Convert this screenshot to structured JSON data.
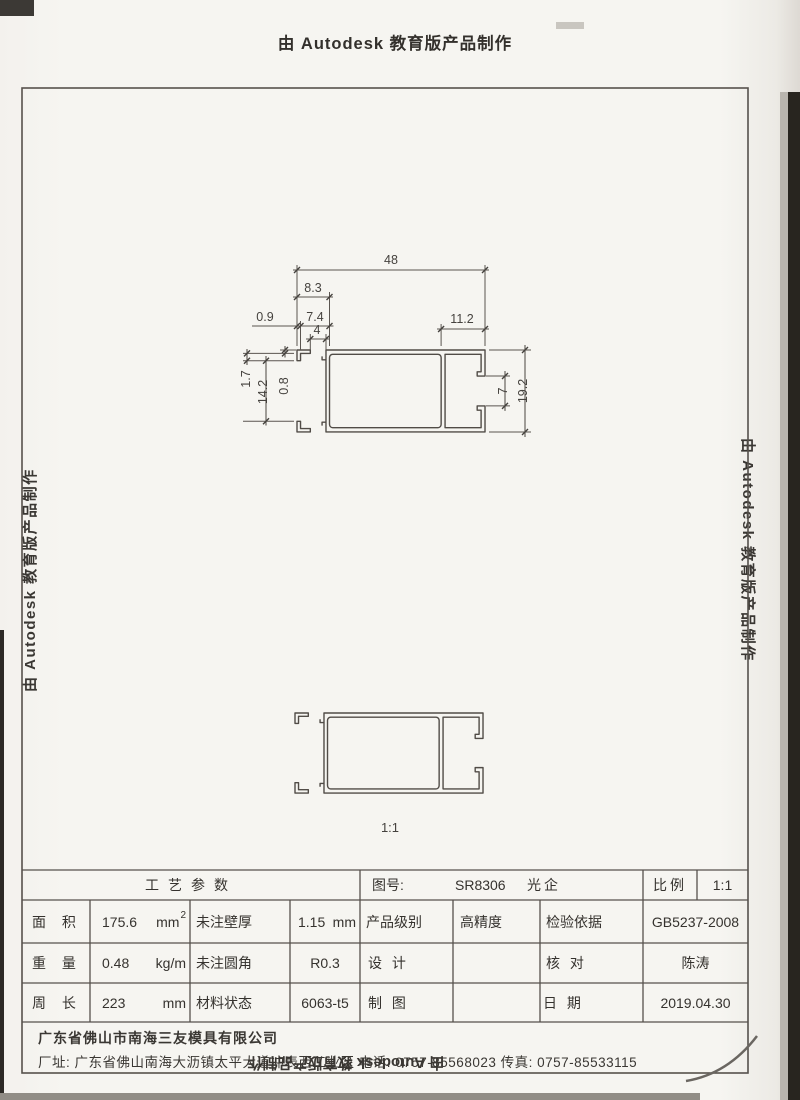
{
  "banner": {
    "text": "由 Autodesk 教育版产品制作"
  },
  "colors": {
    "ink": "#55504b",
    "paper": "#f6f5f1"
  },
  "drawing": {
    "scale_label": "1:1",
    "dims": {
      "w48": "48",
      "w8_3": "8.3",
      "w0_9": "0.9",
      "w7_4": "7.4",
      "w4": "4",
      "w11_2": "11.2",
      "h1_7": "1.7",
      "h14_2": "14.2",
      "h0_8": "0.8",
      "h7": "7",
      "h19_2": "19.2"
    }
  },
  "title_block": {
    "process_header": "工艺参数",
    "area_label": "面 积",
    "area_value": "175.6",
    "area_unit": "mm",
    "area_unit_sup": "2",
    "wall_label": "未注壁厚",
    "wall_value": "1.15",
    "wall_unit": "mm",
    "weight_label": "重 量",
    "weight_value": "0.48",
    "weight_unit": "kg/m",
    "fillet_label": "未注圆角",
    "fillet_value": "R0.3",
    "perimeter_label": "周 长",
    "perimeter_value": "223",
    "perimeter_unit": "mm",
    "material_label": "材料状态",
    "material_value": "6063-t5",
    "drawing_no_label": "图号:",
    "drawing_no": "SR8306",
    "product_name": "光企",
    "scale_label": "比例",
    "scale_value": "1:1",
    "grade_label": "产品级别",
    "grade_value": "高精度",
    "inspection_label": "检验依据",
    "inspection_value": "GB5237-2008",
    "design_label": "设 计",
    "check_label": "核 对",
    "check_value": "陈涛",
    "draft_label": "制 图",
    "date_label": "日 期",
    "date_value": "2019.04.30"
  },
  "footer": {
    "company": "广东省佛山市南海三友模具有限公司",
    "address": "厂址: 广东省佛山南海大沥镇太平大道冲表西工业区 电话: 0757-85568023 传真: 0757-85533115"
  }
}
